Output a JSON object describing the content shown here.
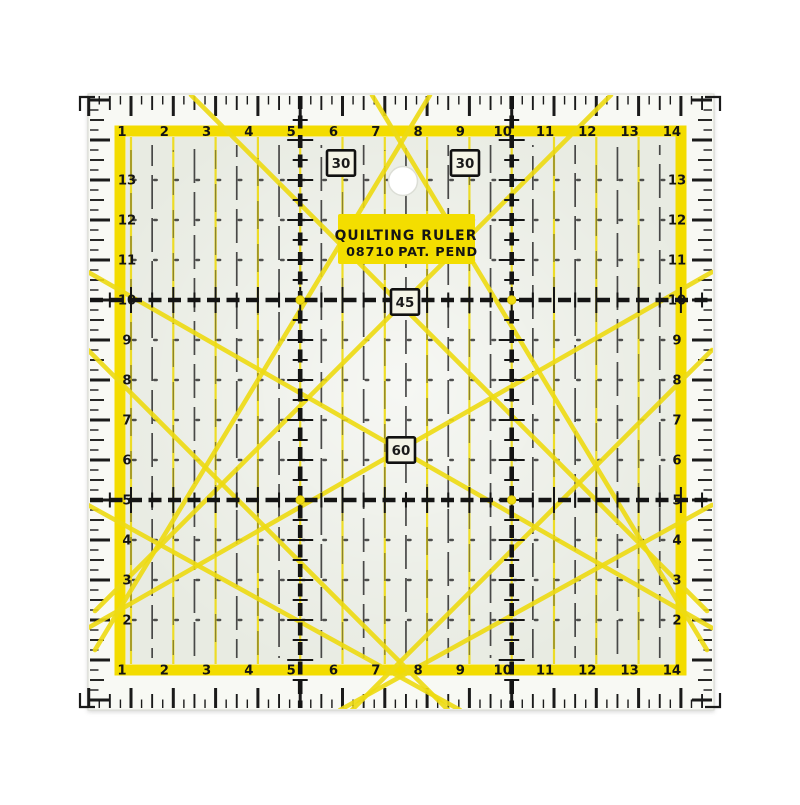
{
  "label": {
    "title": "QUILTING RULER",
    "model": "08710",
    "patent": "PAT. PEND"
  },
  "angle_markers": [
    {
      "value": "30",
      "x": 341,
      "y": 163
    },
    {
      "value": "30",
      "x": 465,
      "y": 163
    },
    {
      "value": "45",
      "x": 405,
      "y": 302
    },
    {
      "value": "60",
      "x": 401,
      "y": 450
    }
  ],
  "scales": {
    "top": [
      "1",
      "2",
      "3",
      "4",
      "5",
      "6",
      "7",
      "8",
      "9",
      "10",
      "11",
      "12",
      "13",
      "14"
    ],
    "bottom": [
      "1",
      "2",
      "3",
      "4",
      "5",
      "6",
      "7",
      "8",
      "9",
      "10",
      "11",
      "12",
      "13",
      "14"
    ],
    "left": [
      "13",
      "12",
      "11",
      "10",
      "9",
      "8",
      "7",
      "6",
      "5",
      "4",
      "3",
      "2"
    ],
    "right": [
      "13",
      "12",
      "11",
      "10",
      "9",
      "8",
      "7",
      "6",
      "5",
      "4",
      "3",
      "2"
    ]
  },
  "colors": {
    "band_yellow": "#f3dc00",
    "line_yellow": "#eedb12",
    "ink_black": "#1a1a1a",
    "body": "#f8f9f4",
    "interior": "#e8ebe2",
    "hole_white": "#ffffff",
    "background": "#ffffff"
  }
}
